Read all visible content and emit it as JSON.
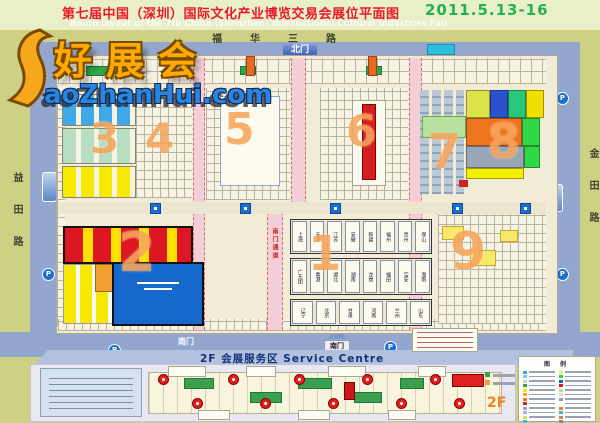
{
  "header": {
    "title_cn": "第七届中国（深圳）国际文化产业博览交易会展位平面图",
    "title_en": "Booth layout of the 7th China (Shenzhen) International Cultural Industries Fair",
    "date": "2011.5.13-16"
  },
  "watermark": {
    "brand_cn": "好展会",
    "brand_en": "aoZhanHui.com"
  },
  "roads": {
    "north": "福华三路",
    "west": "益田路",
    "east": "金田路"
  },
  "gates": {
    "north": "北门",
    "south": "南门",
    "south_corridor": "南门通道"
  },
  "halls": {
    "h1": "1",
    "h2": "2",
    "h3": "3",
    "h4": "4",
    "h5": "5",
    "h6": "6",
    "h7": "7",
    "h8": "8",
    "h9": "9"
  },
  "provinces": {
    "row1": [
      "上海",
      "天津",
      "江苏",
      "安徽",
      "新疆",
      "福州",
      "贵州",
      "保山"
    ],
    "row2": [
      "广东团",
      "香港",
      "湖北",
      "湖南",
      "龙岗",
      "福田",
      "宝安",
      "海南"
    ],
    "row3": [
      "辽宁",
      "北京",
      "甘肃",
      "河南",
      "兰州",
      "山东"
    ]
  },
  "icons": {
    "parking": "P"
  },
  "service": {
    "title": "2F 会展服务区 Service Centre",
    "floor": "2F"
  },
  "legend": {
    "header": "图 例",
    "chips_left": [
      "#3fa8e8",
      "#79c8ee",
      "#b6dec2",
      "#2aa84a",
      "#f6ea00",
      "#f0a030",
      "#ee7420",
      "#e02020",
      "#98a6b8",
      "#c9a0dc",
      "#dce24a",
      "#28c8c8",
      "#1668cc"
    ],
    "chips_right": [
      "#f6e96a",
      "#30d848",
      "#2a52cc",
      "#d41f1f",
      "#b8e09e",
      "#f4ced6",
      "#8ea4b8",
      "#fdfbf0",
      "#f08020",
      "#2ac0dc",
      "#cc8844",
      "#888888",
      "#44cc88"
    ]
  },
  "colors": {
    "background": "#ced083",
    "title_band": "#e9efc8",
    "road": "#93a6ce",
    "map": "#f2ecd6",
    "hall_number": "#f59846",
    "corridor": "#f4ced6",
    "accent_red": "#e81a2a",
    "accent_green": "#23b24e"
  }
}
